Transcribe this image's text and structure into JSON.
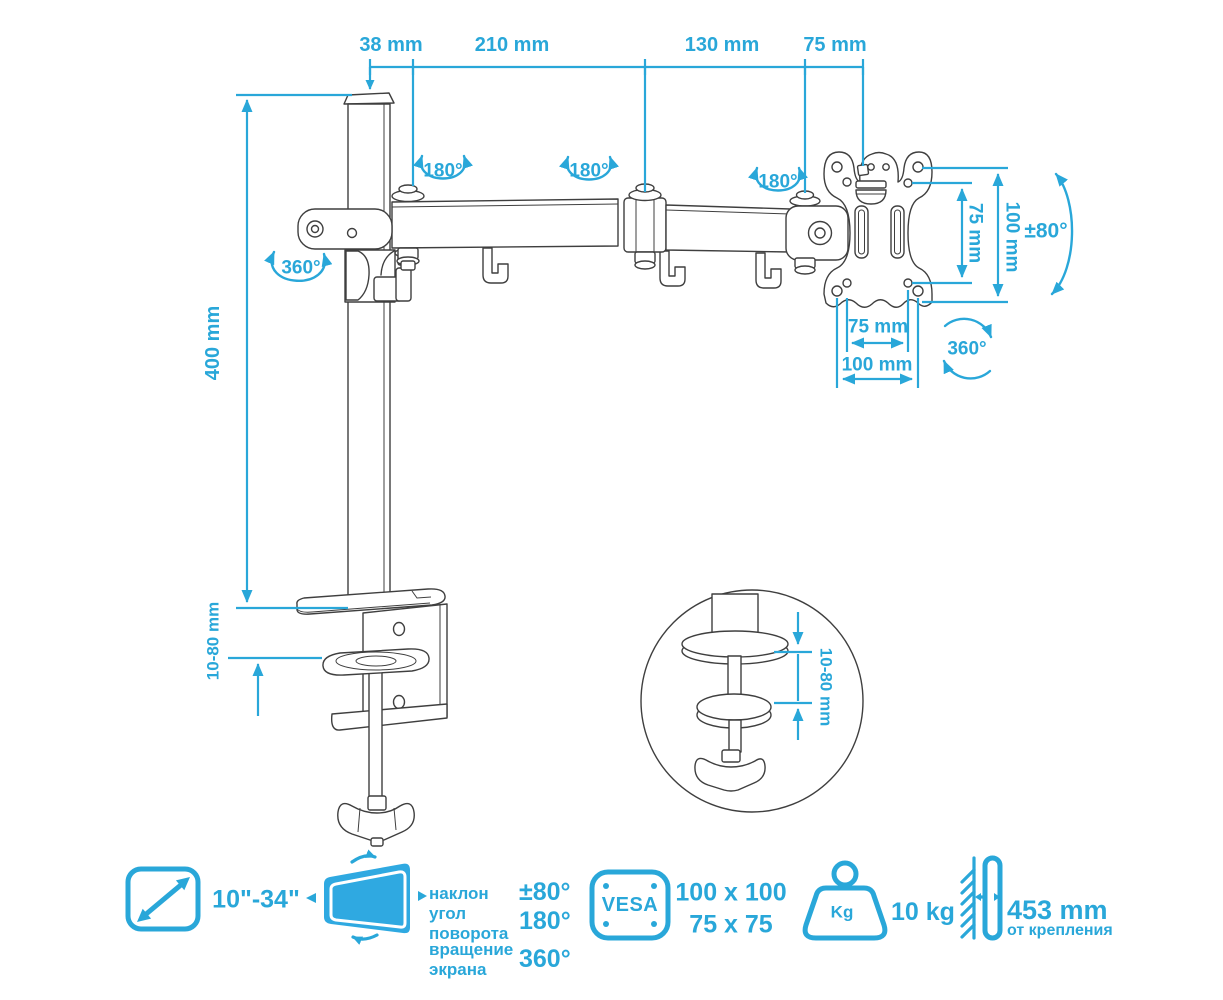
{
  "colors": {
    "accent": "#29a7d9",
    "ink": "#3f3f3f",
    "screen_fill": "#2fa9e1"
  },
  "dimensions": {
    "top_chain": [
      "38 mm",
      "210 mm",
      "130 mm",
      "75 mm"
    ],
    "pole_height": "400 mm",
    "desk_thickness": "10-80 mm",
    "detail_desk_thickness": "10-80 mm",
    "vesa_vertical_inner": "75 mm",
    "vesa_vertical_outer": "100 mm",
    "vesa_horizontal_inner": "75 mm",
    "vesa_horizontal_outer": "100 mm"
  },
  "rotations": {
    "joint1": "180°",
    "joint2": "180°",
    "joint3": "180°",
    "pole_swivel": "360°",
    "screen_tilt": "±80°",
    "vesa_rotation": "360°"
  },
  "legend": {
    "screen_size": "10\"-34\"",
    "specs": [
      {
        "label": "наклон",
        "value": "±80°"
      },
      {
        "label": "угол поворота",
        "value": "180°"
      },
      {
        "label": "вращение экрана",
        "value": "360°"
      }
    ],
    "vesa_label": "VESA",
    "vesa_patterns": [
      "100 x 100",
      "75 x 75"
    ],
    "weight_unit": "Kg",
    "max_load": "10 kg",
    "arm_reach": "453 mm",
    "arm_reach_note": "от крепления"
  }
}
